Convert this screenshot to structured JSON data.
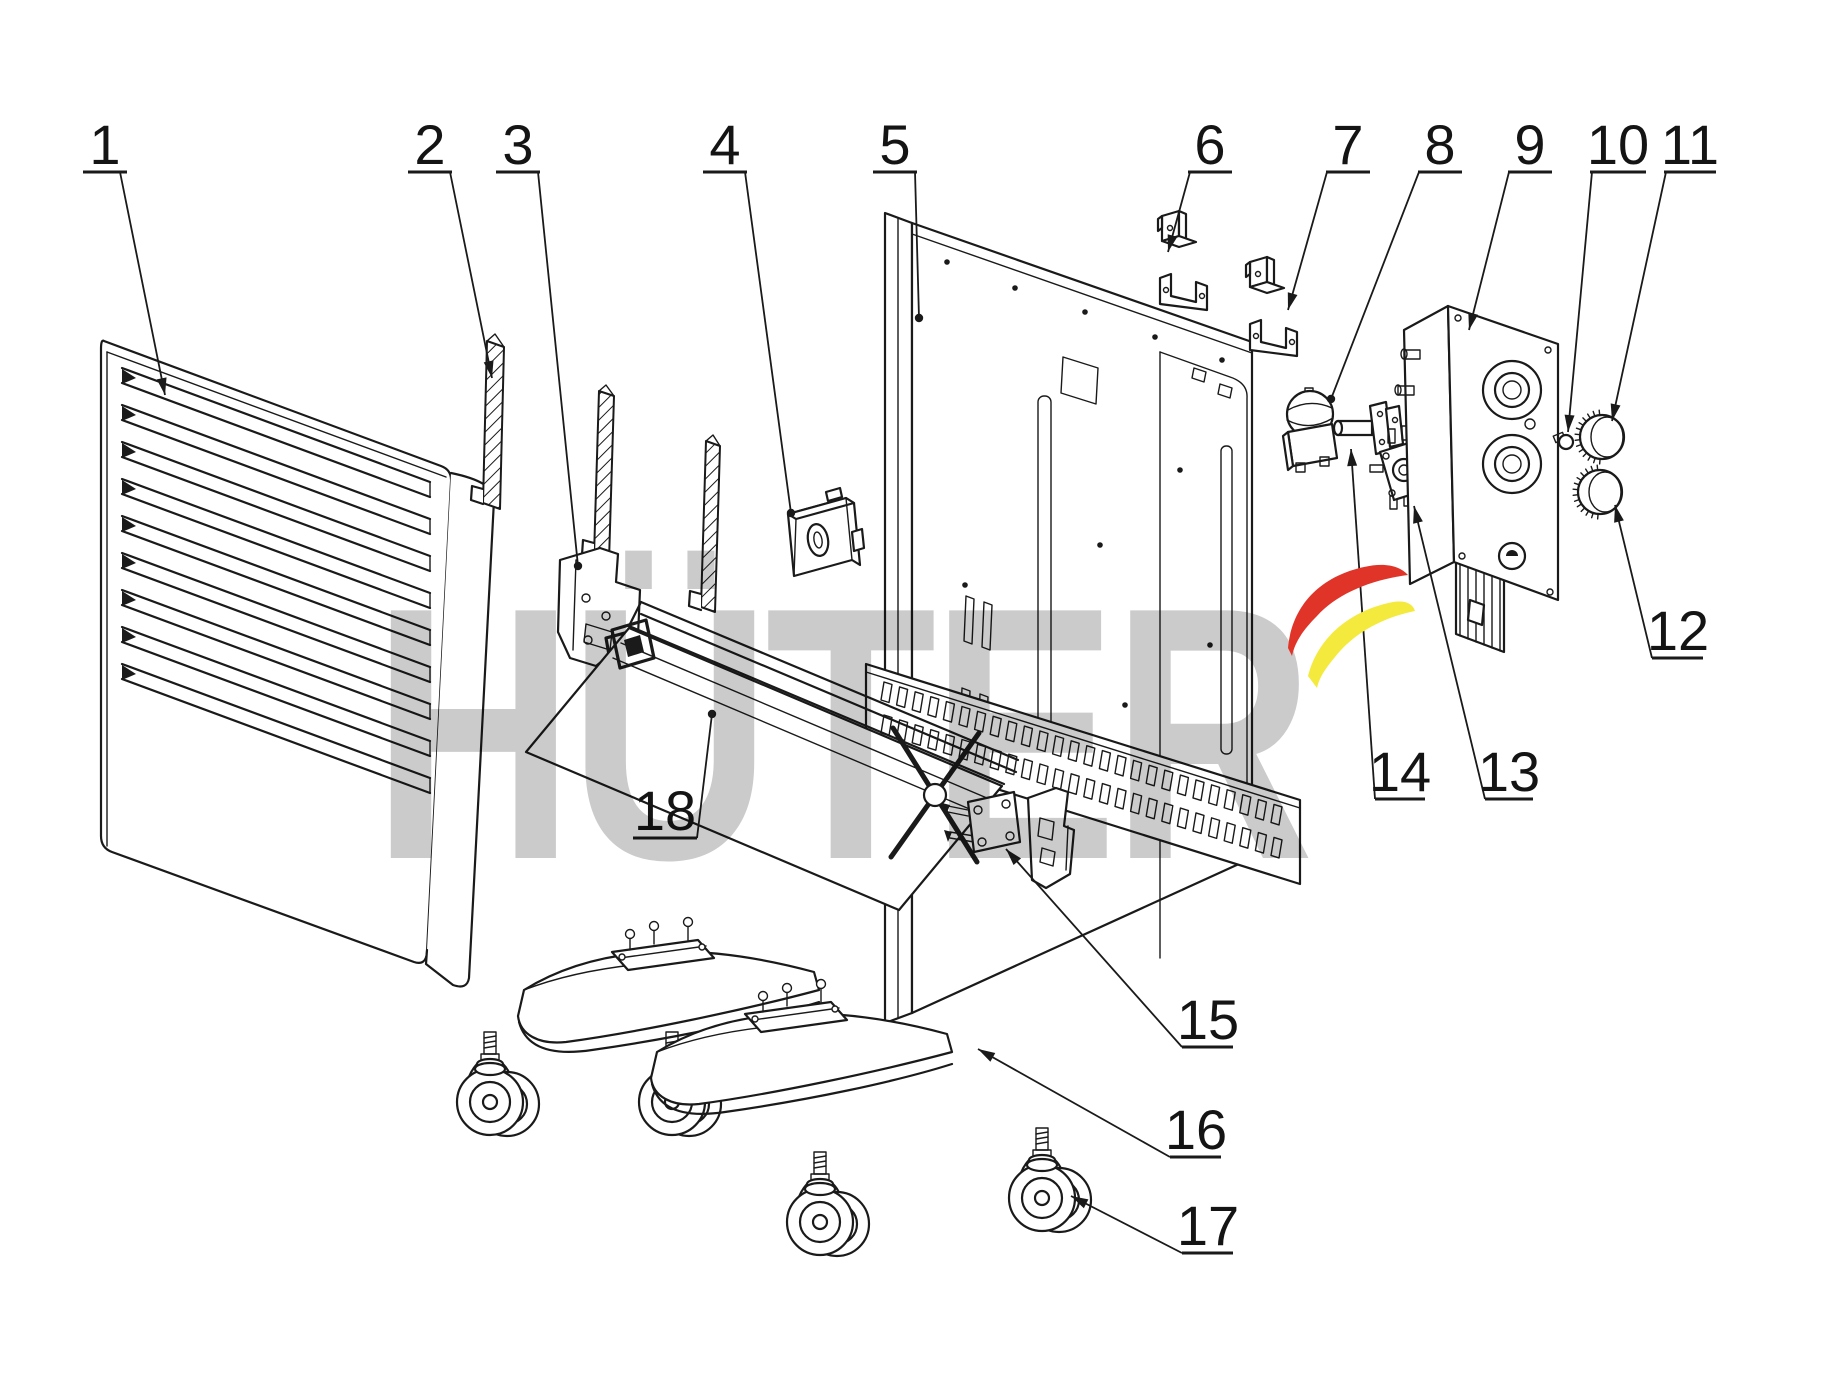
{
  "canvas": {
    "width": 1821,
    "height": 1381
  },
  "colors": {
    "line": "#1a1a1a",
    "watermark_gray": "#cbcbcb",
    "brand_red": "#e03428",
    "brand_yellow": "#f4ea3d"
  },
  "watermark": {
    "text": "HÜTER"
  },
  "louvers": {
    "count": 9
  },
  "grille": {
    "rows": 2,
    "cols": 26
  },
  "parts": [
    {
      "num": "1",
      "name": "front-panel",
      "cx": 105,
      "by": 164,
      "ul": [
        83,
        127,
        172
      ],
      "leader": [
        [
          120,
          172
        ],
        [
          165,
          395
        ]
      ],
      "tip": "arrow"
    },
    {
      "num": "2",
      "name": "mounting-strip",
      "cx": 430,
      "by": 164,
      "ul": [
        408,
        452,
        172
      ],
      "leader": [
        [
          450,
          172
        ],
        [
          492,
          378
        ]
      ],
      "tip": "arrow"
    },
    {
      "num": "3",
      "name": "hinge-bracket",
      "cx": 518,
      "by": 164,
      "ul": [
        496,
        540,
        172
      ],
      "leader": [
        [
          538,
          172
        ],
        [
          578,
          566
        ]
      ],
      "tip": "dot"
    },
    {
      "num": "4",
      "name": "switch-housing",
      "cx": 725,
      "by": 164,
      "ul": [
        703,
        747,
        172
      ],
      "leader": [
        [
          745,
          172
        ],
        [
          791,
          513
        ]
      ],
      "tip": "dot"
    },
    {
      "num": "5",
      "name": "back-panel",
      "cx": 895,
      "by": 164,
      "ul": [
        873,
        917,
        172
      ],
      "leader": [
        [
          915,
          172
        ],
        [
          919,
          318
        ]
      ],
      "tip": "dot"
    },
    {
      "num": "6",
      "name": "wall-bracket-upper",
      "cx": 1210,
      "by": 164,
      "ul": [
        1188,
        1232,
        172
      ],
      "leader": [
        [
          1190,
          172
        ],
        [
          1168,
          252
        ]
      ],
      "tip": "arrow"
    },
    {
      "num": "7",
      "name": "wall-bracket-lower",
      "cx": 1348,
      "by": 164,
      "ul": [
        1326,
        1370,
        172
      ],
      "leader": [
        [
          1327,
          172
        ],
        [
          1288,
          310
        ]
      ],
      "tip": "arrow"
    },
    {
      "num": "8",
      "name": "thermostat",
      "cx": 1440,
      "by": 164,
      "ul": [
        1418,
        1462,
        172
      ],
      "leader": [
        [
          1419,
          172
        ],
        [
          1331,
          399
        ]
      ],
      "tip": "dot"
    },
    {
      "num": "9",
      "name": "control-panel",
      "cx": 1530,
      "by": 164,
      "ul": [
        1508,
        1552,
        172
      ],
      "leader": [
        [
          1509,
          172
        ],
        [
          1469,
          330
        ]
      ],
      "tip": "arrow"
    },
    {
      "num": "10",
      "name": "retainer-pin",
      "cx": 1618,
      "by": 164,
      "ul": [
        1590,
        1646,
        172
      ],
      "leader": [
        [
          1592,
          172
        ],
        [
          1568,
          432
        ]
      ],
      "tip": "arrow"
    },
    {
      "num": "11",
      "name": "knob-upper",
      "cx": 1690,
      "by": 164,
      "ul": [
        1664,
        1716,
        172
      ],
      "leader": [
        [
          1666,
          172
        ],
        [
          1612,
          421
        ]
      ],
      "tip": "arrow"
    },
    {
      "num": "12",
      "name": "knob-lower",
      "cx": 1678,
      "by": 650,
      "ul": [
        1652,
        1703,
        658
      ],
      "leader": [
        [
          1652,
          658
        ],
        [
          1615,
          505
        ]
      ],
      "tip": "arrow"
    },
    {
      "num": "13",
      "name": "rotary-switch",
      "cx": 1509,
      "by": 791,
      "ul": [
        1485,
        1533,
        799
      ],
      "leader": [
        [
          1485,
          799
        ],
        [
          1414,
          506
        ]
      ],
      "tip": "arrow"
    },
    {
      "num": "14",
      "name": "thermostat-shaft",
      "cx": 1400,
      "by": 791,
      "ul": [
        1375,
        1425,
        799
      ],
      "leader": [
        [
          1375,
          799
        ],
        [
          1351,
          449
        ]
      ],
      "tip": "arrow"
    },
    {
      "num": "15",
      "name": "foot-bracket",
      "cx": 1208,
      "by": 1039,
      "ul": [
        1182,
        1233,
        1047
      ],
      "leader": [
        [
          1182,
          1047
        ],
        [
          1006,
          849
        ]
      ],
      "tip": "arrow"
    },
    {
      "num": "16",
      "name": "foot",
      "cx": 1196,
      "by": 1149,
      "ul": [
        1170,
        1221,
        1157
      ],
      "leader": [
        [
          1170,
          1157
        ],
        [
          978,
          1049
        ]
      ],
      "tip": "arrow"
    },
    {
      "num": "17",
      "name": "caster-wheel",
      "cx": 1208,
      "by": 1245,
      "ul": [
        1182,
        1233,
        1253
      ],
      "leader": [
        [
          1182,
          1253
        ],
        [
          1071,
          1196
        ]
      ],
      "tip": "arrow"
    },
    {
      "num": "18",
      "name": "heating-element",
      "cx": 665,
      "by": 830,
      "ul": [
        633,
        697,
        838
      ],
      "leader": [
        [
          697,
          838
        ],
        [
          712,
          714
        ]
      ],
      "tip": "dot"
    }
  ]
}
